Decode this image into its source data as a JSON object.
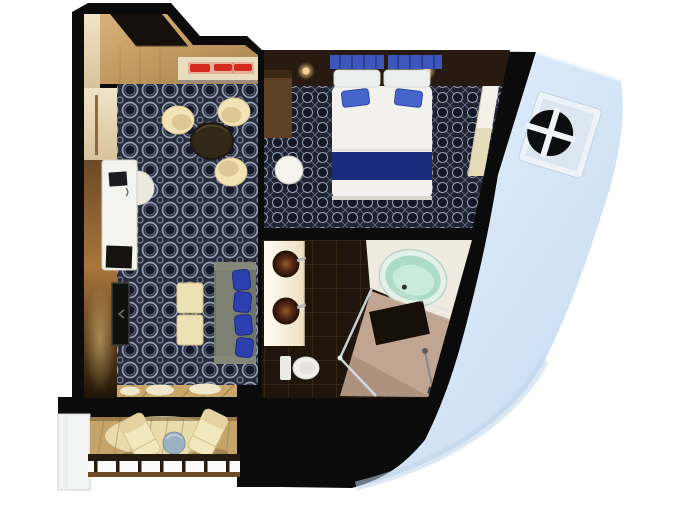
{
  "scene": {
    "type": "floorplan-3d-render",
    "subject": "cruise-ship-suite",
    "view": "top-down",
    "background": "#ffffff"
  },
  "colors": {
    "background": "#ffffff",
    "walls": "#0b0b0c",
    "hull": "#d6e6f7",
    "hull_shade": "#c0d6ea",
    "porthole_dark": "#0d0e10",
    "living_carpet_base": "#272c3c",
    "carpet_ring": "#97a0b6",
    "bedroom_carpet_base": "#202432",
    "bed_white": "#f2f1ec",
    "bed_runner": "#1c2a7e",
    "pillow_blue": "#3f5ec6",
    "headboard_wood": "#281a10",
    "lamp_glow": "#ffd98f",
    "furniture_cream": "#f1e3b4",
    "table_dark": "#32281a",
    "sofa_gray": "#70756a",
    "sofa_pillow_blue": "#2c3fae",
    "wood_floor": "#c9a76b",
    "wall_wood": "#8a5f33",
    "counter_cream": "#e9ddc0",
    "accent_red": "#d32a20",
    "vanity_white": "#f7f1e2",
    "sink_brown": "#4a2313",
    "toilet_white": "#f0f0ed",
    "tile_brown": "#20150c",
    "tub_mint": "#abdcc6",
    "shower_beige": "#c9ad9b",
    "deck_wood": "#c4a469",
    "railing_dark": "#241a10",
    "railing_wood": "#6e4a26",
    "divider_white": "#f3f5f5",
    "balcony_table_blue": "#9db0c2",
    "dresser_wood": "#5d4124"
  },
  "rooms": {
    "entry": {
      "name": "entry",
      "items": [
        "entry-door",
        "sideboard-counter",
        "red-glass-accents"
      ]
    },
    "living_room": {
      "name": "living-room",
      "items": [
        "desk",
        "desk-chair",
        "laptop",
        "tv-panel",
        "armchairs",
        "round-table",
        "sofa",
        "blue-throw-pillows",
        "ottomans",
        "patterned-carpet",
        "curtains"
      ]
    },
    "bedroom": {
      "name": "bedroom",
      "items": [
        "double-bed",
        "navy-bed-runner",
        "blue-pillows",
        "headboard",
        "bedside-lamps",
        "dresser",
        "round-side-table",
        "wardrobe",
        "patterned-carpet"
      ]
    },
    "bathroom": {
      "name": "bathroom",
      "items": [
        "double-vanity",
        "vessel-sinks",
        "toilet",
        "oval-bathtub",
        "tub-platform",
        "glass-shower",
        "dark-tile-floor"
      ]
    },
    "balcony": {
      "name": "balcony",
      "items": [
        "lounge-chairs",
        "round-table",
        "railing",
        "privacy-divider",
        "wood-deck"
      ]
    },
    "exterior": {
      "name": "ship-hull",
      "items": [
        "hull-panel",
        "porthole-window"
      ]
    }
  },
  "counts": {
    "armchairs": 3,
    "sofa_pillows": 4,
    "ottomans": 2,
    "lounge_chairs": 2,
    "sinks": 2,
    "red_accents": 3
  }
}
